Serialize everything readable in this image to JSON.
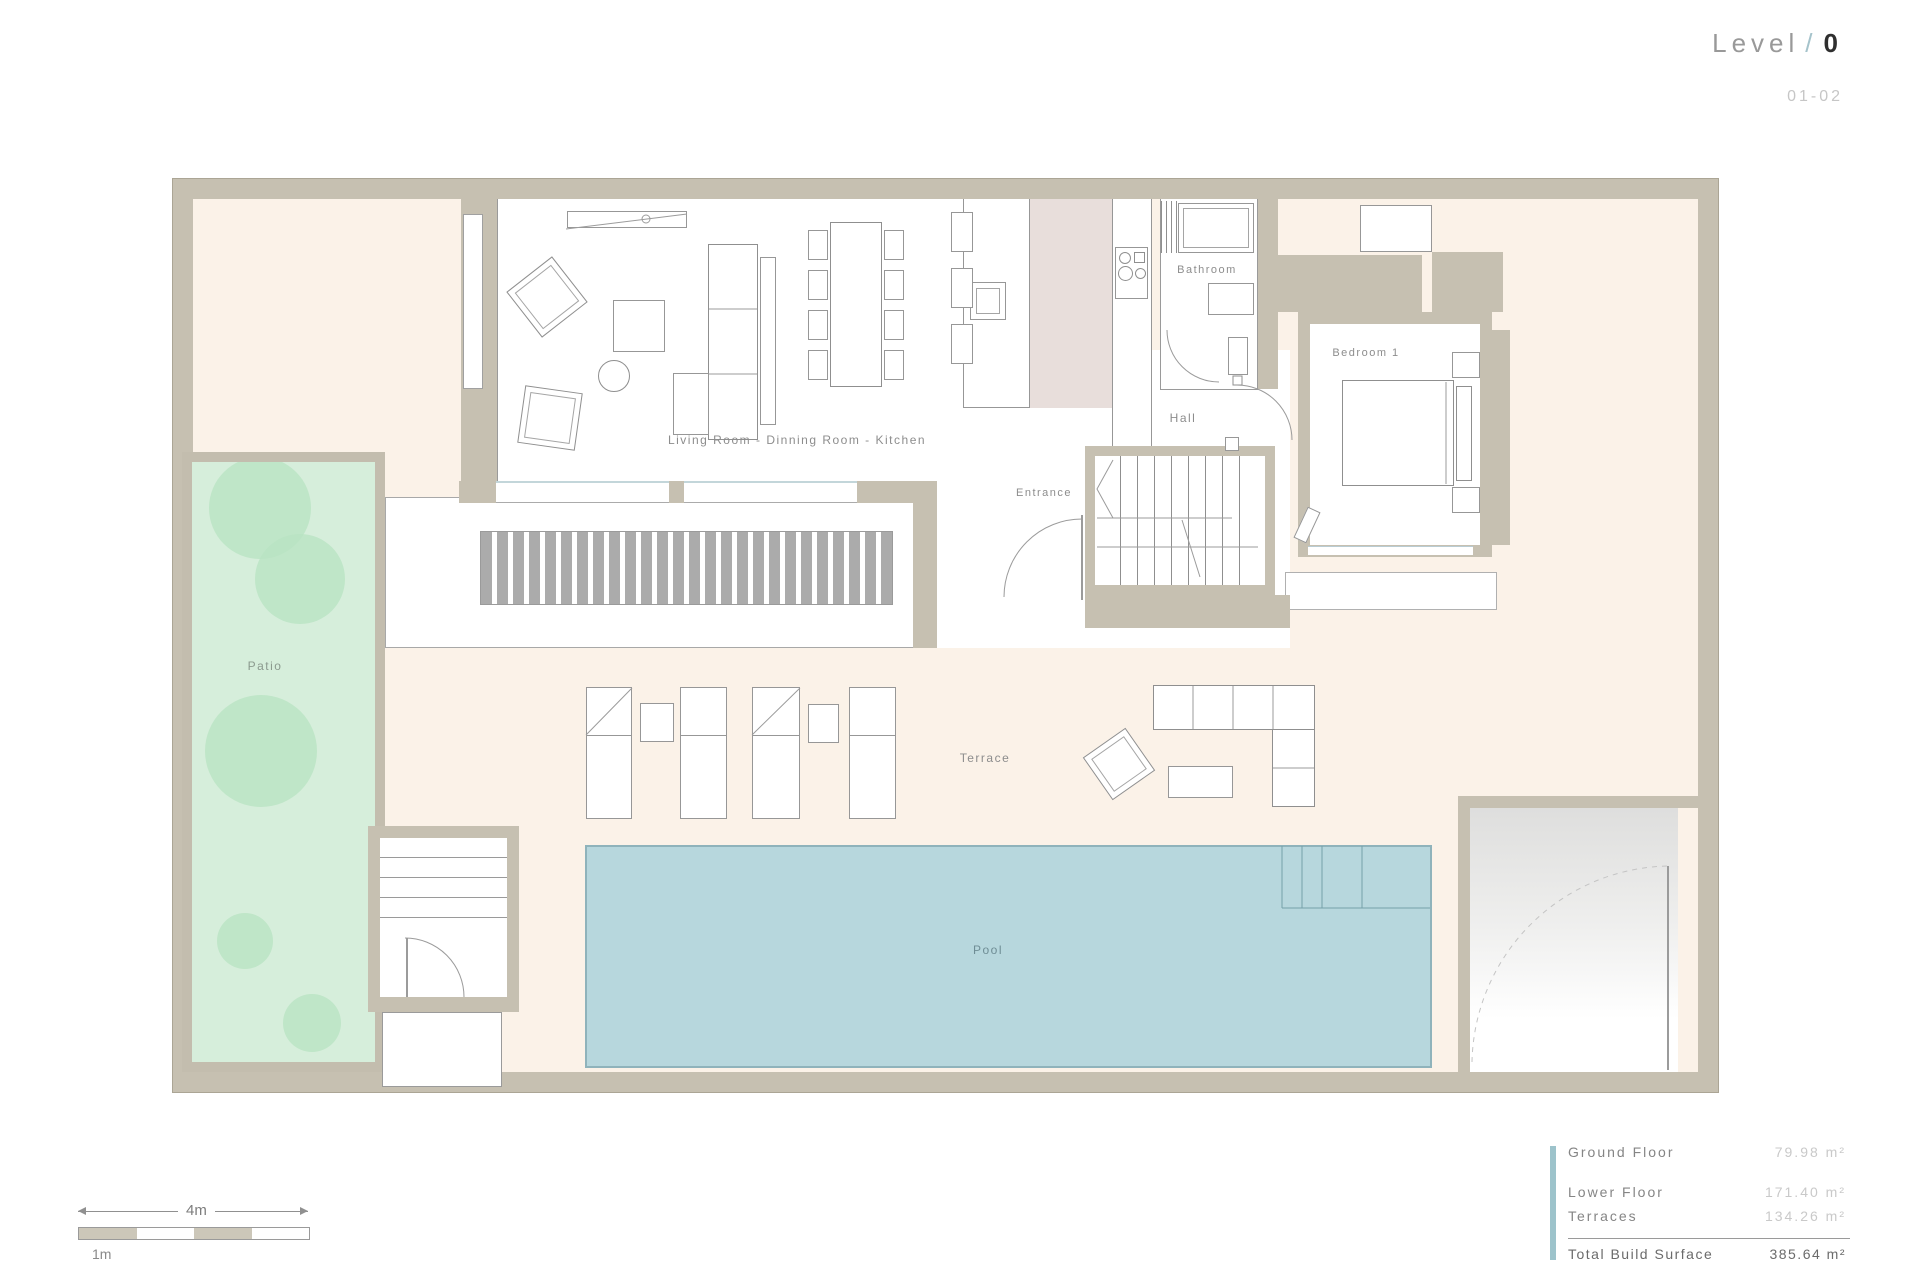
{
  "sheet": {
    "level_label": "Level",
    "level_separator": "/",
    "level_number": "0",
    "sheet_number": "01-02"
  },
  "rooms": {
    "living": "Living Room - Dinning Room - Kitchen",
    "bathroom": "Bathroom",
    "hall": "Hall",
    "entrance": "Entrance",
    "bedroom": "Bedroom 1",
    "patio": "Patio",
    "terrace": "Terrace",
    "pool": "Pool"
  },
  "scale_bar": {
    "total_label": "4m",
    "segment_label": "1m"
  },
  "area_summary": {
    "rows": [
      {
        "label": "Ground Floor",
        "value": "79.98",
        "unit": "m²"
      },
      {
        "label": "Lower Floor",
        "value": "171.40",
        "unit": "m²"
      },
      {
        "label": "Terraces",
        "value": "134.26",
        "unit": "m²"
      }
    ],
    "total": {
      "label": "Total Build Surface",
      "value": "385.64",
      "unit": "m²"
    }
  },
  "colors": {
    "wall": "#c6c0b1",
    "terrace_floor": "#fbf2e8",
    "patio_green": "#d6eedb",
    "tree_green": "#b9e4c3",
    "pool_blue": "#b7d7dd",
    "kitchen_pink": "#e8dedb",
    "accent_teal": "#9dc3cb"
  }
}
